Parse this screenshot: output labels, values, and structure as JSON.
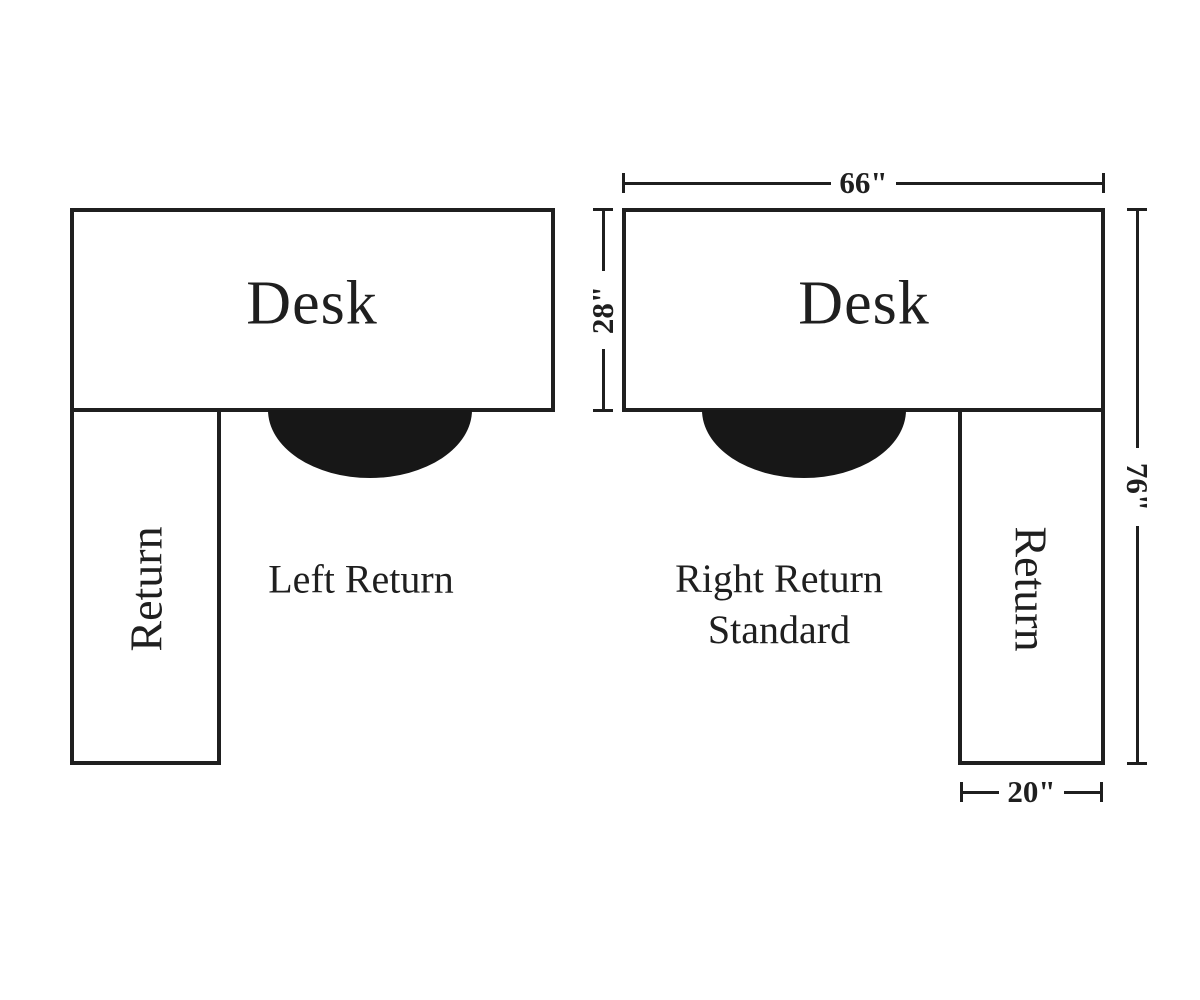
{
  "page": {
    "background": "#ffffff",
    "ink": "#1f1f1f",
    "chair_color": "#171717"
  },
  "left_diagram": {
    "desk_label": "Desk",
    "return_label": "Return",
    "caption": "Left Return"
  },
  "right_diagram": {
    "desk_label": "Desk",
    "return_label": "Return",
    "caption_line1": "Right Return",
    "caption_line2": "Standard",
    "dimensions": {
      "desk_width": "66\"",
      "desk_depth": "28\"",
      "overall_depth": "76\"",
      "return_width": "20\""
    }
  }
}
